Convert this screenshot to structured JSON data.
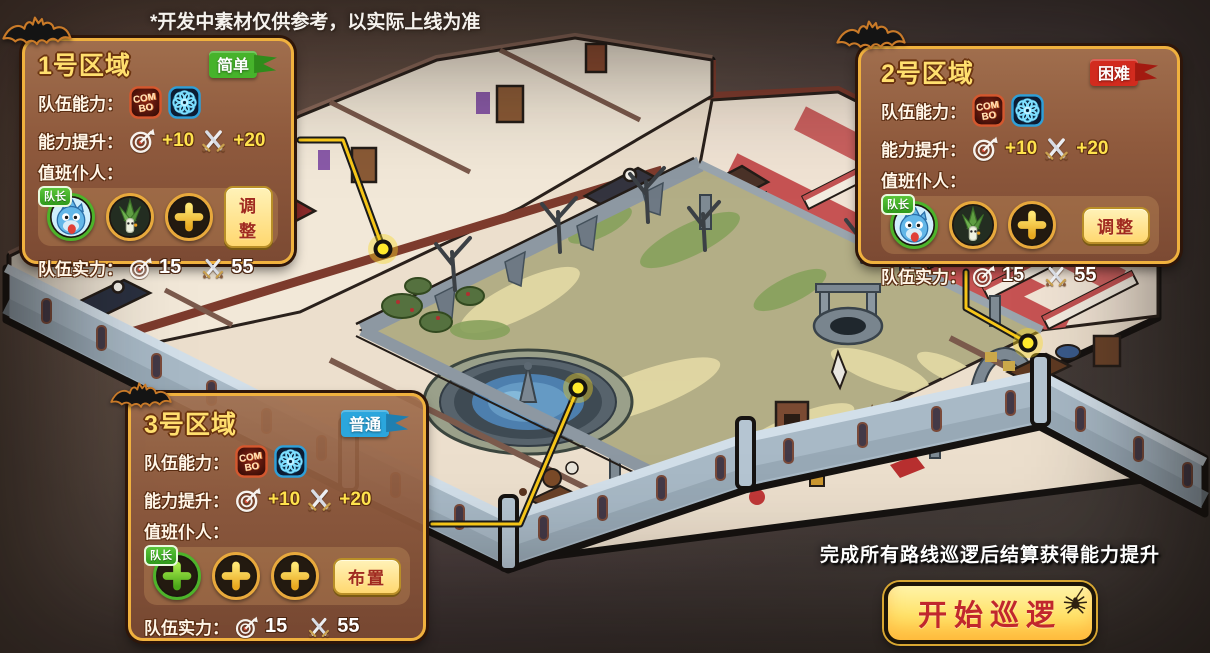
{
  "disclaimer": "*开发中素材仅供参考，以实际上线为准",
  "labels": {
    "team_ability": "队伍能力：",
    "ability_boost": "能力提升：",
    "duty_servants": "值班仆人：",
    "team_strength": "队伍实力：",
    "captain": "队长"
  },
  "zones": [
    {
      "title": "1号区域",
      "difficulty": "简单",
      "difficulty_color": "#46b32b",
      "difficulty_dark": "#2f8c1b",
      "boost_focus": "+10",
      "boost_attack": "+20",
      "strength_focus": "15",
      "strength_attack": "55",
      "action": "调整"
    },
    {
      "title": "2号区域",
      "difficulty": "困难",
      "difficulty_color": "#d22b1e",
      "difficulty_dark": "#a31a10",
      "boost_focus": "+10",
      "boost_attack": "+20",
      "strength_focus": "15",
      "strength_attack": "55",
      "action": "调整"
    },
    {
      "title": "3号区域",
      "difficulty": "普通",
      "difficulty_color": "#2ba6dd",
      "difficulty_dark": "#1f7fb0",
      "boost_focus": "+10",
      "boost_attack": "+20",
      "strength_focus": "15",
      "strength_attack": "55",
      "action": "布置"
    }
  ],
  "footer": {
    "hint": "完成所有路线巡逻后结算获得能力提升",
    "start_button": "开始巡逻"
  }
}
